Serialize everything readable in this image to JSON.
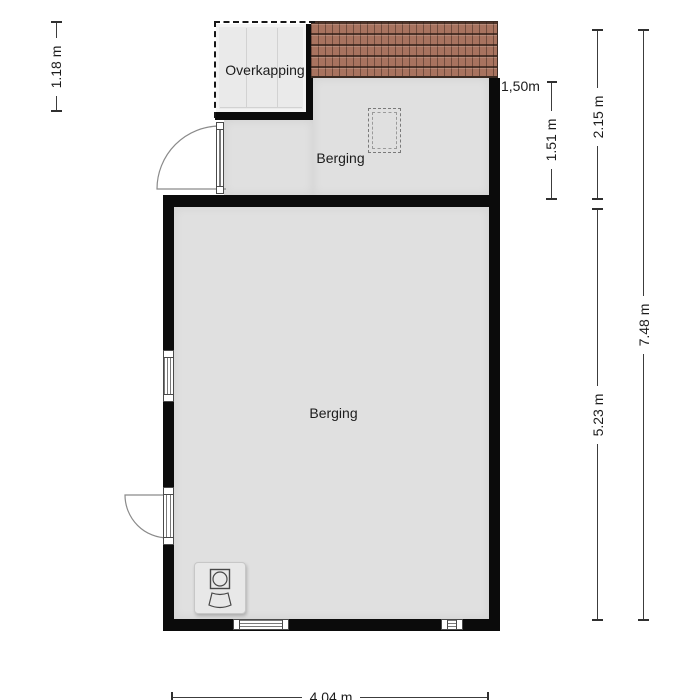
{
  "floorplan": {
    "rooms": {
      "overkapping": {
        "label": "Overkapping"
      },
      "berging_upper": {
        "label": "Berging"
      },
      "berging_lower": {
        "label": "Berging"
      }
    },
    "dimensions": {
      "overkapping_depth": "1.18 m",
      "roof_height_line": "1,50m",
      "berging_upper_depth": "1.51 m",
      "upper_section_depth": "2.15 m",
      "berging_lower_depth": "5.23 m",
      "total_depth": "7.48 m",
      "berging_lower_width": "4.04 m"
    },
    "symbols": {
      "washing_machine": "washing-machine",
      "roof_window": "roof-window",
      "roof_tiles": "roof-tiles"
    },
    "colors": {
      "wall": "#0b0b0b",
      "floor": "#e0e0e0",
      "overkapping_floor": "#eaeaea",
      "roof_tile": "#a8735f",
      "roof_tile_dark": "#3a2a22",
      "dimension_line": "#3c3c3c"
    }
  }
}
